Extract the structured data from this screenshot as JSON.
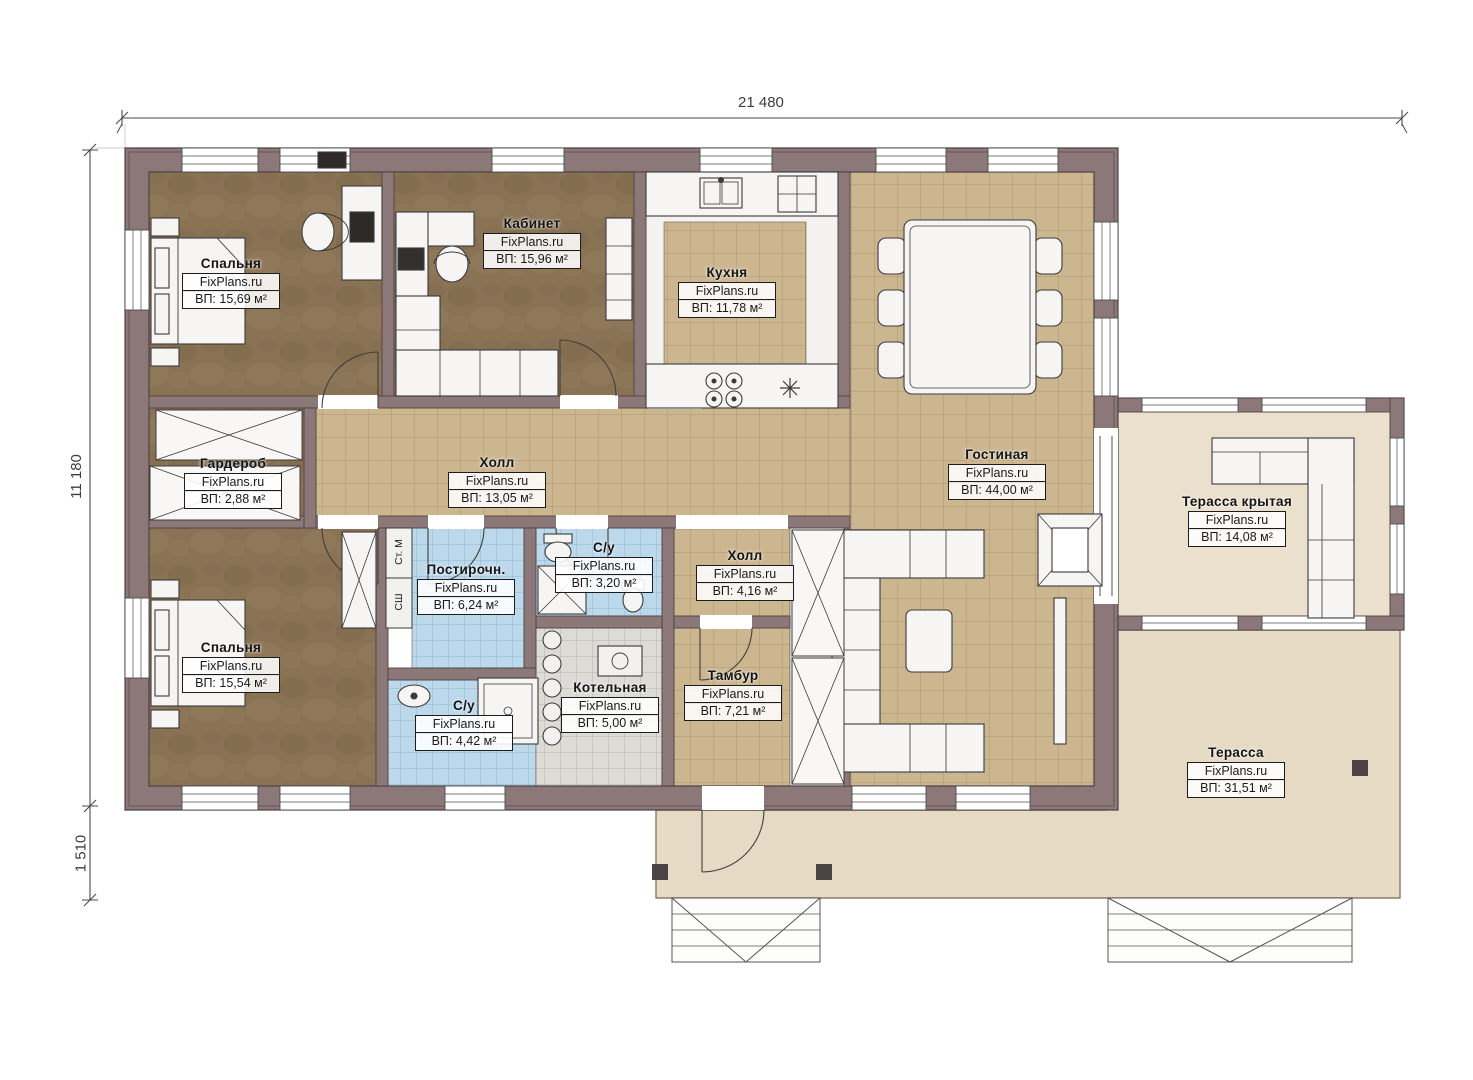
{
  "plan": {
    "watermark": "FixPlans.ru",
    "dimensions": {
      "top": "21 480",
      "left": "11 180",
      "bottom_left": "1 510"
    },
    "appliances": {
      "washer": "Ст. М",
      "dryer": "СШ"
    },
    "colors": {
      "wall": "#8c7878",
      "wood_floor": "#8a7355",
      "tile_floor": "#ccb690",
      "wet_tile": "#bcd9ec",
      "boiler_tile": "#dddbd6",
      "terrace": "#e6dac4",
      "covered_terrace": "#ebdfcd"
    },
    "rooms": [
      {
        "name": "Спальня",
        "area": "ВП: 15,69 м²"
      },
      {
        "name": "Кабинет",
        "area": "ВП: 15,96 м²"
      },
      {
        "name": "Кухня",
        "area": "ВП: 11,78 м²"
      },
      {
        "name": "Гостиная",
        "area": "ВП: 44,00 м²"
      },
      {
        "name": "Гардероб",
        "area": "ВП: 2,88 м²"
      },
      {
        "name": "Холл",
        "area": "ВП: 13,05 м²"
      },
      {
        "name": "Терасса крытая",
        "area": "ВП: 14,08 м²"
      },
      {
        "name": "Спальня",
        "area": "ВП: 15,54 м²"
      },
      {
        "name": "Постирочн.",
        "area": "ВП: 6,24 м²"
      },
      {
        "name": "С/у",
        "area": "ВП: 3,20 м²"
      },
      {
        "name": "Холл",
        "area": "ВП: 4,16 м²"
      },
      {
        "name": "С/у",
        "area": "ВП: 4,42 м²"
      },
      {
        "name": "Котельная",
        "area": "ВП: 5,00 м²"
      },
      {
        "name": "Тамбур",
        "area": "ВП: 7,21 м²"
      },
      {
        "name": "Терасса",
        "area": "ВП: 31,51 м²"
      }
    ]
  }
}
